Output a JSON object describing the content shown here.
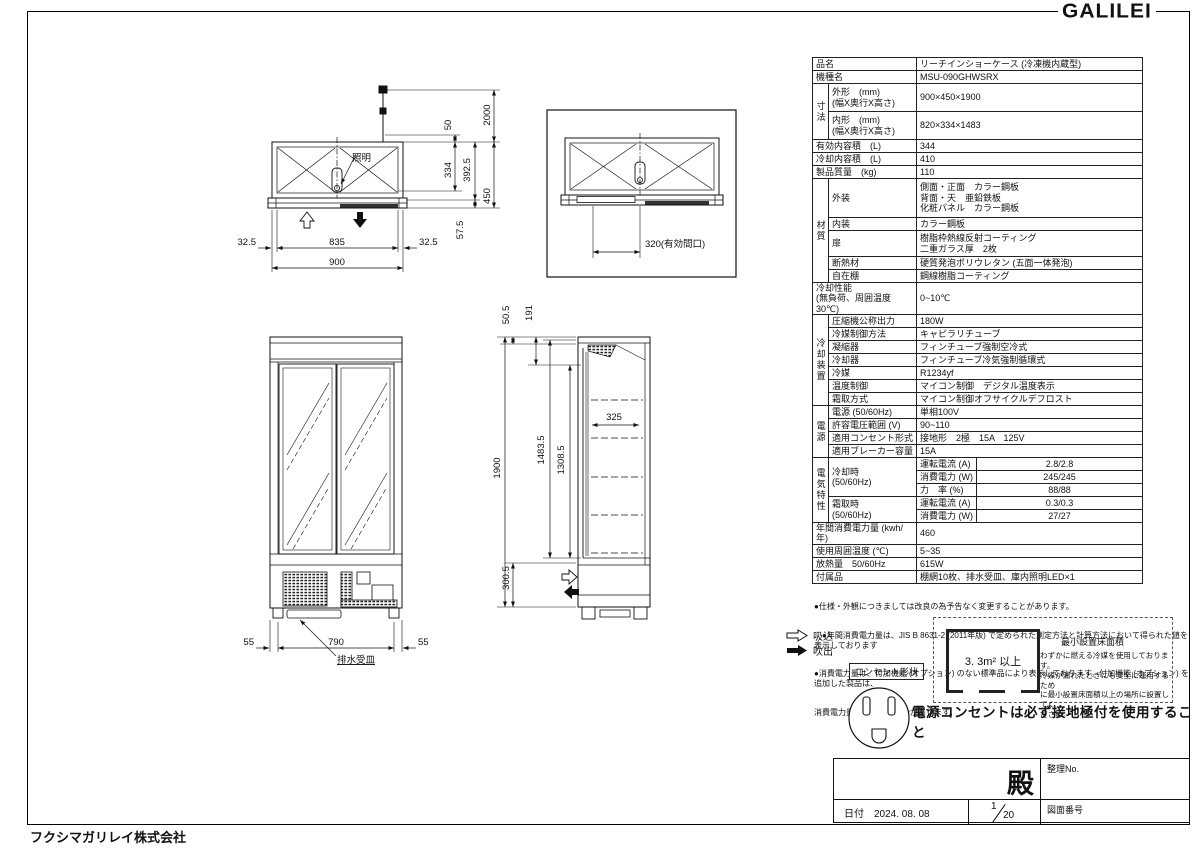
{
  "logo": "GALILEI",
  "company": "フクシマガリレイ株式会社",
  "spec": {
    "hinmei_label": "品名",
    "hinmei": "リーチインショーケース (冷凍機内蔵型)",
    "kishumei_label": "機種名",
    "kishumei": "MSU-090GHWSRX",
    "sunpo_label": "寸法",
    "gaikei_label": "外形　(mm)\n(幅X奥行X高さ)",
    "gaikei": "900×450×1900",
    "naikei_label": "内形　(mm)\n(幅X奥行X高さ)",
    "naikei": "820×334×1483",
    "yuko_label": "有効内容積　(L)",
    "yuko": "344",
    "reikyaku_label": "冷却内容積　(L)",
    "reikyaku": "410",
    "mass_label": "製品質量　(kg)",
    "mass": "110",
    "zaishitsu_label": "材質",
    "gaiso_label": "外装",
    "gaiso": "側面・正面　カラー鋼板\n背面・天　亜鉛鉄板\n化粧パネル　カラー鋼板",
    "naiso_label": "内装",
    "naiso": "カラー鋼板",
    "tobira_label": "扉",
    "tobira": "樹脂枠熱線反射コーティング\n二重ガラス厚　2枚",
    "dannetsu_label": "断熱材",
    "dannetsu": "硬質発泡ポリウレタン (五面一体発泡)",
    "jizaidana_label": "自在棚",
    "jizaidana": "鋼線樹脂コーティング",
    "seino_label": "冷却性能\n(無負荷、周囲温度30℃)",
    "seino": "0~10℃",
    "sochi_label": "冷却装置",
    "asshuku_label": "圧縮機公称出力",
    "asshuku": "180W",
    "reibai_seigyo_label": "冷媒制御方法",
    "reibai_seigyo": "キャピラリチューブ",
    "gyoshuku_label": "凝縮器",
    "gyoshuku": "フィンチューブ強制空冷式",
    "reikyakuki_label": "冷却器",
    "reikyakuki": "フィンチューブ冷気強制循環式",
    "reibai_label": "冷媒",
    "reibai": "R1234yf",
    "ondo_label": "温度制御",
    "ondo": "マイコン制御　デジタル温度表示",
    "shimotori_label": "霜取方式",
    "shimotori": "マイコン制御オフサイクルデフロスト",
    "dengen_group_label": "電源",
    "dengen_label": "電源 (50/60Hz)",
    "dengen": "単相100V",
    "kyoyo_label": "許容電圧範囲 (V)",
    "kyoyo": "90~110",
    "consent_label": "適用コンセント形式",
    "consent": "接地形　2極　15A　125V",
    "breaker_label": "適用ブレーカー容量",
    "breaker": "15A",
    "denki_group_label": "電気特性",
    "cooling_label": "冷却時\n(50/60Hz)",
    "current_label": "運転電流 (A)",
    "cool_current": "2.8/2.8",
    "power_label": "消費電力 (W)",
    "cool_power": "245/245",
    "pf_label": "力　率 (%)",
    "cool_pf": "88/88",
    "defrost_label": "霜取時\n(50/60Hz)",
    "def_current": "0.3/0.3",
    "def_power": "27/27",
    "nenkan_label": "年間消費電力量 (kwh/年)",
    "nenkan": "460",
    "shuui_label": "使用周囲温度 (℃)",
    "shuui": "5~35",
    "hounetsu_label": "放熱量　50/60Hz",
    "hounetsu": "615W",
    "fuzoku_label": "付属品",
    "fuzoku": "棚網10枚、排水受皿、庫内照明LED×1"
  },
  "notes": {
    "line1": "●仕様・外観につきましては改良の為予告なく変更することがあります。",
    "line2": "　●年間消費電力量は、JIS B 8631-2 (2011年版) で定められた測定方法と計算方法において得られた値を表示しております",
    "line3": "●消費電力量は、付加機能 (オプション) のない標準品により表示しております。付加機能 (オプション) を追加した製品は、",
    "line4": "消費電力量が増加する場合があります。"
  },
  "legend": {
    "suction": "吸込",
    "discharge": "吹出",
    "outlet_shape": "コンセント形状",
    "warning": "電源コンセントは必ず接地極付を使用すること"
  },
  "min_area": {
    "value": "3. 3m² 以上",
    "title": "最小設置床面積",
    "body": "わずかに燃える冷媒を使用しております。\n冷媒が漏れたときにも安全に運用するため\nに最小設置床面積以上の場所に設置してく\nださい。"
  },
  "title_block": {
    "dono": "殿",
    "seiri_no": "整理No.",
    "date_label": "日付　2024. 08. 08",
    "page_num": "1",
    "page_total": "20",
    "drawing_no_label": "図面番号"
  },
  "drawing": {
    "plan": {
      "light": "照明",
      "d32_5l": "32.5",
      "d835": "835",
      "d32_5r": "32.5",
      "d900": "900",
      "d50": "50",
      "d2000": "2000",
      "d334": "334",
      "d392_5": "392.5",
      "d450": "450",
      "d57_5": "57.5"
    },
    "open": {
      "d320": "320(有効間口)"
    },
    "front": {
      "d55l": "55",
      "d790": "790",
      "d55r": "55",
      "drain": "排水受皿"
    },
    "side": {
      "d50_5": "50.5",
      "d191": "191",
      "d1900": "1900",
      "d1483_5": "1483.5",
      "d1308_5": "1308.5",
      "d300_5": "300.5",
      "d325": "325"
    }
  }
}
